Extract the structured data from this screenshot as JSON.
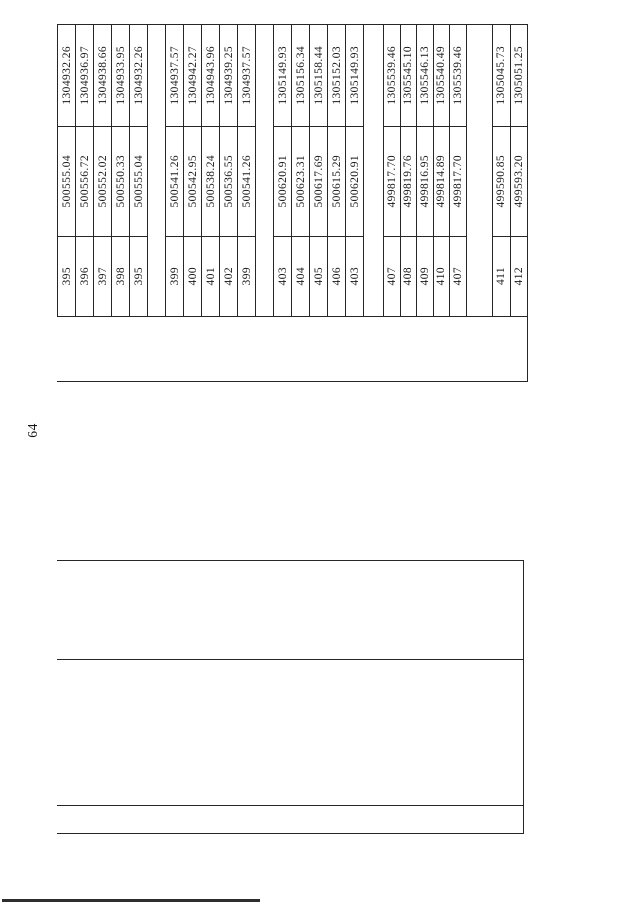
{
  "page": {
    "number": "64"
  },
  "coordinate_table": {
    "groups": [
      {
        "records": [
          {
            "point": "395",
            "x": "500555.04",
            "y": "1304932.26"
          },
          {
            "point": "396",
            "x": "500556.72",
            "y": "1304936.97"
          },
          {
            "point": "397",
            "x": "500552.02",
            "y": "1304938.66"
          },
          {
            "point": "398",
            "x": "500550.33",
            "y": "1304933.95"
          },
          {
            "point": "395",
            "x": "500555.04",
            "y": "1304932.26"
          }
        ]
      },
      {
        "records": [
          {
            "point": "399",
            "x": "500541.26",
            "y": "1304937.57"
          },
          {
            "point": "400",
            "x": "500542.95",
            "y": "1304942.27"
          },
          {
            "point": "401",
            "x": "500538.24",
            "y": "1304943.96"
          },
          {
            "point": "402",
            "x": "500536.55",
            "y": "1304939.25"
          },
          {
            "point": "399",
            "x": "500541.26",
            "y": "1304937.57"
          }
        ]
      },
      {
        "records": [
          {
            "point": "403",
            "x": "500620.91",
            "y": "1305149.93"
          },
          {
            "point": "404",
            "x": "500623.31",
            "y": "1305156.34"
          },
          {
            "point": "405",
            "x": "500617.69",
            "y": "1305158.44"
          },
          {
            "point": "406",
            "x": "500615.29",
            "y": "1305152.03"
          },
          {
            "point": "403",
            "x": "500620.91",
            "y": "1305149.93"
          }
        ]
      },
      {
        "records": [
          {
            "point": "407",
            "x": "499817.70",
            "y": "1305539.46"
          },
          {
            "point": "408",
            "x": "499819.76",
            "y": "1305545.10"
          },
          {
            "point": "409",
            "x": "499816.95",
            "y": "1305546.13"
          },
          {
            "point": "410",
            "x": "499814.89",
            "y": "1305540.49"
          },
          {
            "point": "407",
            "x": "499817.70",
            "y": "1305539.46"
          }
        ]
      },
      {
        "records": [
          {
            "point": "411",
            "x": "499590.85",
            "y": "1305045.73"
          },
          {
            "point": "412",
            "x": "499593.20",
            "y": "1305051.25"
          }
        ]
      }
    ]
  }
}
